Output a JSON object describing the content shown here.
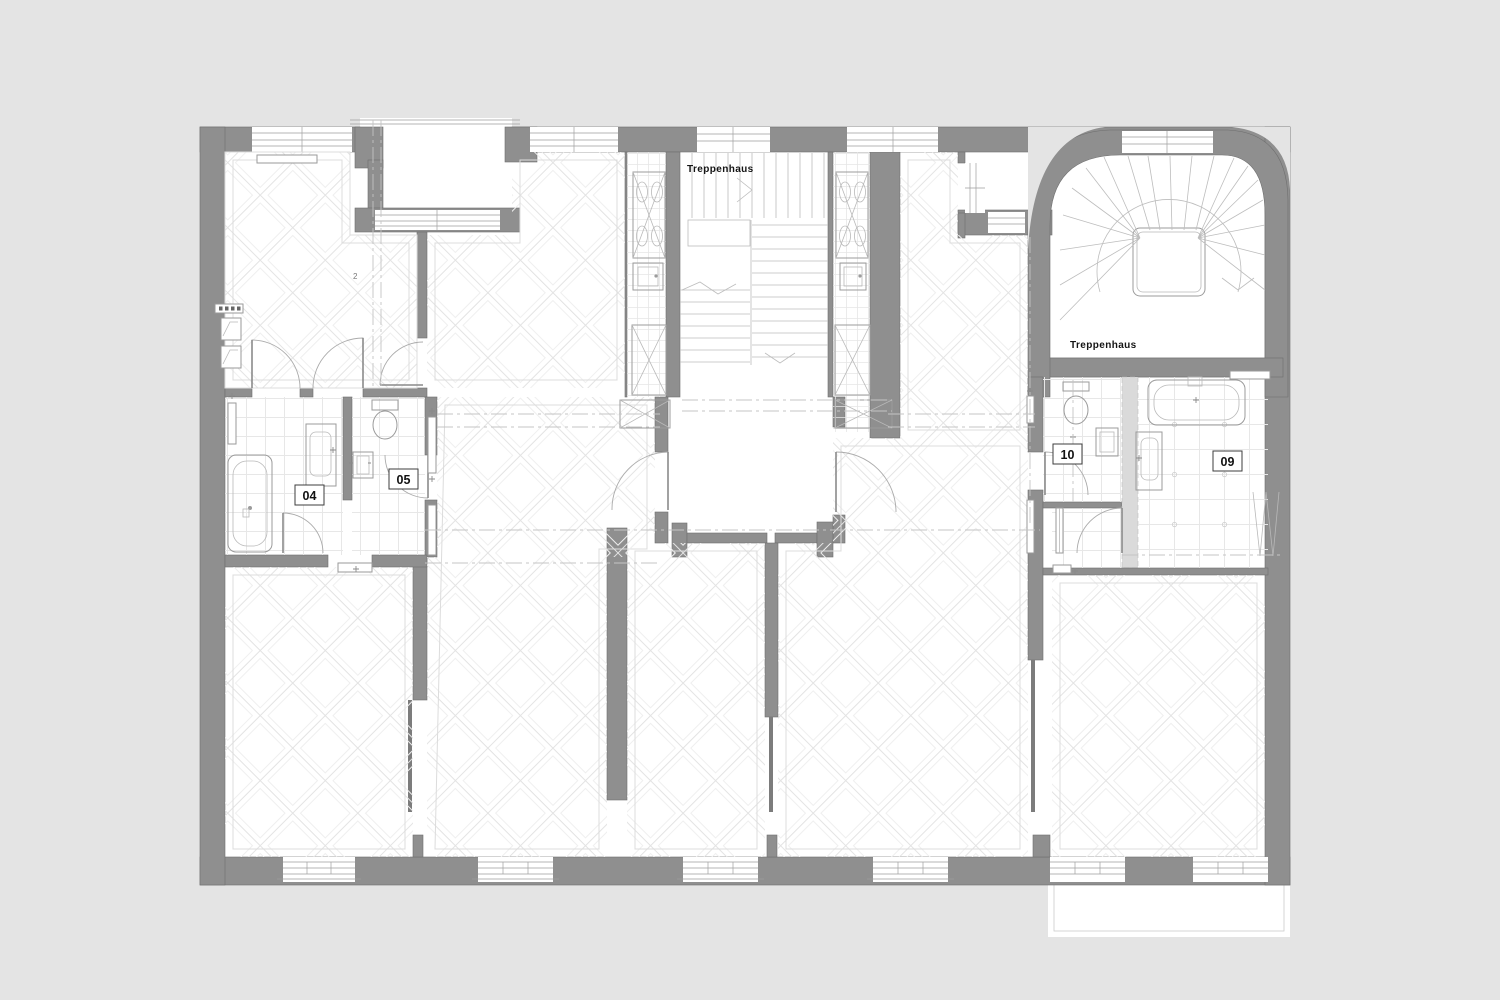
{
  "document": {
    "type": "architectural-floor-plan",
    "view": "upper floor with two stairwells, two apartments, bathrooms and parquet rooms"
  },
  "colors": {
    "background": "#e4e4e4",
    "wall": "#8f8f8f",
    "paper": "#ffffff",
    "pattern_line": "#e3e3e3",
    "fixture_line": "#9b9b9b",
    "text": "#141414"
  },
  "labels": {
    "stairwell_center": "Treppenhaus",
    "stairwell_right": "Treppenhaus",
    "room_2": "2"
  },
  "rooms": {
    "r04": {
      "number": "04",
      "type": "bathroom with bathtub and vanity"
    },
    "r05": {
      "number": "05",
      "type": "wc with toilet and hand basin"
    },
    "r09": {
      "number": "09",
      "type": "bathroom with bathtub and vanity"
    },
    "r10": {
      "number": "10",
      "type": "wc with toilet and hand basin"
    }
  }
}
